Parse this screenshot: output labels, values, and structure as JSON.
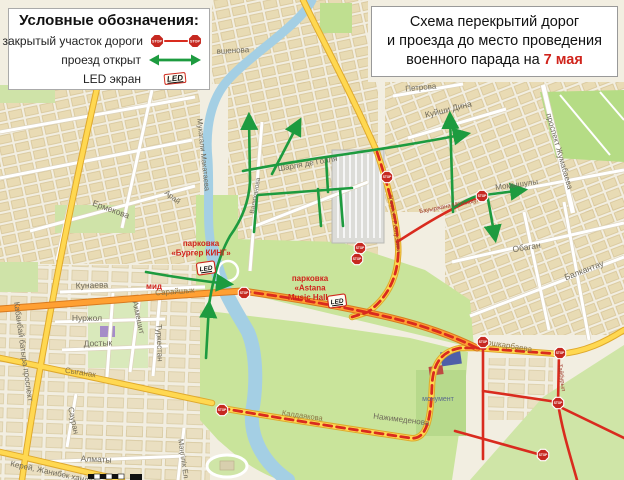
{
  "legend": {
    "title": "Условные обозначения:",
    "items": [
      {
        "label": "закрытый участок дороги",
        "symbol": "closed-road"
      },
      {
        "label": "проезд открыт",
        "symbol": "open-road"
      },
      {
        "label": "LED экран",
        "symbol": "led-screen"
      }
    ],
    "stop_sign_text": "STOP",
    "led_text": "LED"
  },
  "title_box": {
    "line1": "Схема перекрытий дорог",
    "line2": "и проезда до место проведения",
    "line3_prefix": "военного парада на ",
    "date_highlight": "7 мая"
  },
  "map": {
    "street_labels": {
      "ovshenova": "вшенова",
      "makataeva": "Мукагали Макатаева",
      "ermekova": "Ермекова",
      "arai": "Арай",
      "charles": "Шарля де Голля",
      "valikhanova": "Валиханова",
      "respubliki": "проспект Республики",
      "petrova": "Петрова",
      "kuishi_dina": "Куйши Дина",
      "zhumabaeva": "проспект Жумабаева",
      "momyshuly": "Момышулы",
      "bauyrzhan": "Бауыржана Момышулы",
      "obagan": "Обаган",
      "balkantau": "Балкантау",
      "koshkarbaeva": "Кошкарбаева",
      "taiburyl": "Тайбурыл",
      "nazhimedenova": "Нажимеденова",
      "kaldayakova": "Калдаякова",
      "mangilik_el": "Мәңгілік Ел",
      "kerey": "Керей, Жанибек хандар",
      "almaty": "Алматы",
      "sauran": "Сауран",
      "syganak": "Сыганак",
      "kabanbay": "Кабанбай батыра проспект",
      "kunaeva": "Кунаева",
      "nurzhol": "Нуржол",
      "dostyk": "Достык",
      "akmeshit": "Акмешит",
      "turkestan": "Туркестан",
      "sarayshyk": "Сарайшык"
    },
    "poi_labels": {
      "mid": "мид",
      "monument": "монумент"
    },
    "parking_labels": [
      {
        "lines": [
          "парковка",
          "«Бургер КИНГ»"
        ]
      },
      {
        "lines": [
          "парковка",
          "«Astana",
          "Music Hall»"
        ]
      }
    ]
  },
  "colors": {
    "closed_red": "#d92b1e",
    "route_green": "#1d9b3f",
    "road_yellow": "#ffd851",
    "road_orange": "#ffa033",
    "accent_red": "#d0241c"
  }
}
